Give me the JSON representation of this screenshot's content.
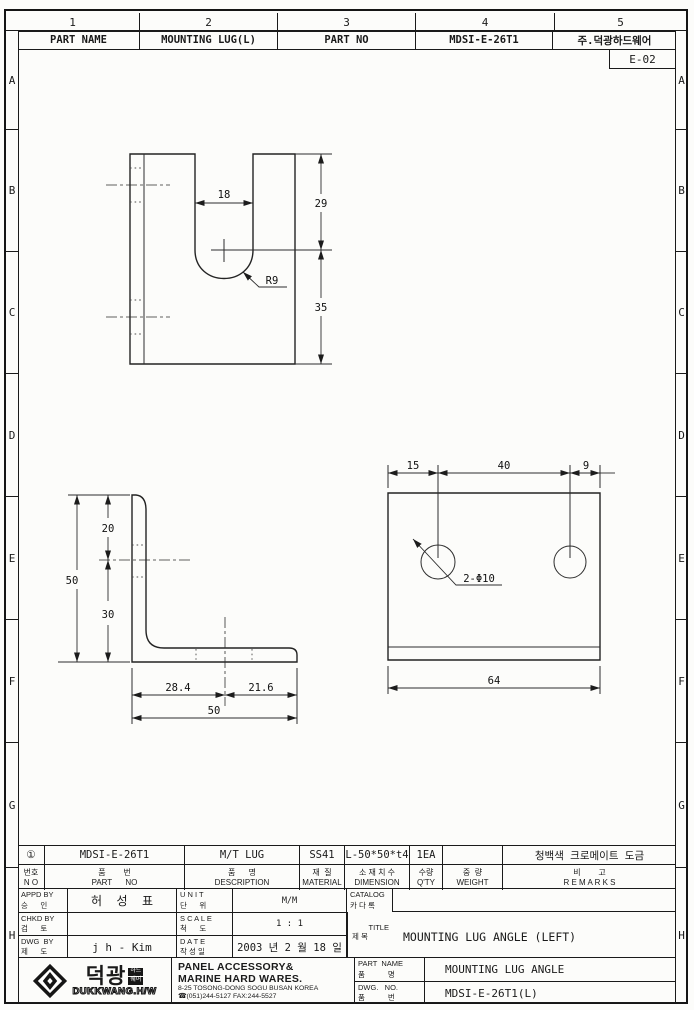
{
  "sheet": {
    "zone_numbers": [
      "1",
      "2",
      "3",
      "4",
      "5"
    ],
    "zone_letters": [
      "A",
      "B",
      "C",
      "D",
      "E",
      "F",
      "G",
      "H"
    ],
    "doc_code": "E-02"
  },
  "header": {
    "part_name_label": "PART NAME",
    "part_name_value": "MOUNTING LUG(L)",
    "part_no_label": "PART NO",
    "part_no_value": "MDSI-E-26T1",
    "company_name": "주.덕광하드웨어"
  },
  "views": {
    "slot_view": {
      "slot_width": "18",
      "upper_height": "29",
      "lower_height": "35",
      "radius": "R9"
    },
    "side_view": {
      "hole_offset_top": "20",
      "height": "50",
      "hole_offset_bottom": "30",
      "base_left": "28.4",
      "base_right": "21.6",
      "width": "50"
    },
    "front_view": {
      "edge_to_hole": "15",
      "hole_pitch": "40",
      "hole_to_edge": "9",
      "holes": "2-Φ10",
      "width": "64"
    }
  },
  "parts_table": {
    "headers": {
      "no": {
        "ko": "번호",
        "en": "N O"
      },
      "part_no": {
        "ko": "품        번",
        "en": "PART      NO"
      },
      "description": {
        "ko": "품      명",
        "en": "DESCRIPTION"
      },
      "material": {
        "ko": "재  질",
        "en": "MATERIAL"
      },
      "dimension": {
        "ko": "소 재 치 수",
        "en": "DIMENSION"
      },
      "qty": {
        "ko": "수량",
        "en": "Q'TY"
      },
      "weight": {
        "ko": "중  량",
        "en": "WEIGHT"
      },
      "remarks": {
        "ko": "비        고",
        "en": "R E M A R K S"
      }
    },
    "row": {
      "no": "①",
      "part_no": "MDSI-E-26T1",
      "description": "M/T LUG",
      "material": "SS41",
      "dimension": "L-50*50*t4",
      "qty": "1EA",
      "weight": "",
      "remarks": "청백색 크로메이트 도금"
    }
  },
  "approval": {
    "appd": {
      "label_en": "APPD BY",
      "label_ko": "승      인",
      "value": "허  성  표"
    },
    "chkd": {
      "label_en": "CHKD BY",
      "label_ko": "검      토",
      "value": ""
    },
    "dwg": {
      "label_en": "DWG  BY",
      "label_ko": "제      도",
      "value": "j h - Kim"
    },
    "unit": {
      "label_en": "U N I T",
      "label_ko": "단      위",
      "value": "M/M"
    },
    "scale": {
      "label_en": "S C A L E",
      "label_ko": "척      도",
      "value": "1 : 1"
    },
    "date": {
      "label_en": "D A T E",
      "label_ko": "작 성 일",
      "value": "2003 년 2 월 18 일"
    },
    "catalog": {
      "label_en": "CATALOG",
      "label_ko": "카 다 록",
      "value": ""
    },
    "title": {
      "label_en": "TITLE",
      "label_ko": "제 목",
      "value": "MOUNTING LUG ANGLE (LEFT)"
    }
  },
  "company": {
    "logo_name": "덕광",
    "logo_badge_top": "하드",
    "logo_badge_bottom": "웨어",
    "logo_roman": "DUKKWANG.H/W",
    "line1": "PANEL ACCESSORY&",
    "line2": "MARINE HARD WARES.",
    "line3": "8-25 TOSONG-DONG SOGU BUSAN KOREA",
    "line4": "☎(051)244-5127 FAX:244-5527",
    "part_name": {
      "label_en": "PART  NAME",
      "label_ko": "품           명",
      "value": "MOUNTING LUG ANGLE"
    },
    "dwg_no": {
      "label_en": "DWG.   NO.",
      "label_ko": "품           번",
      "value": "MDSI-E-26T1(L)"
    }
  }
}
